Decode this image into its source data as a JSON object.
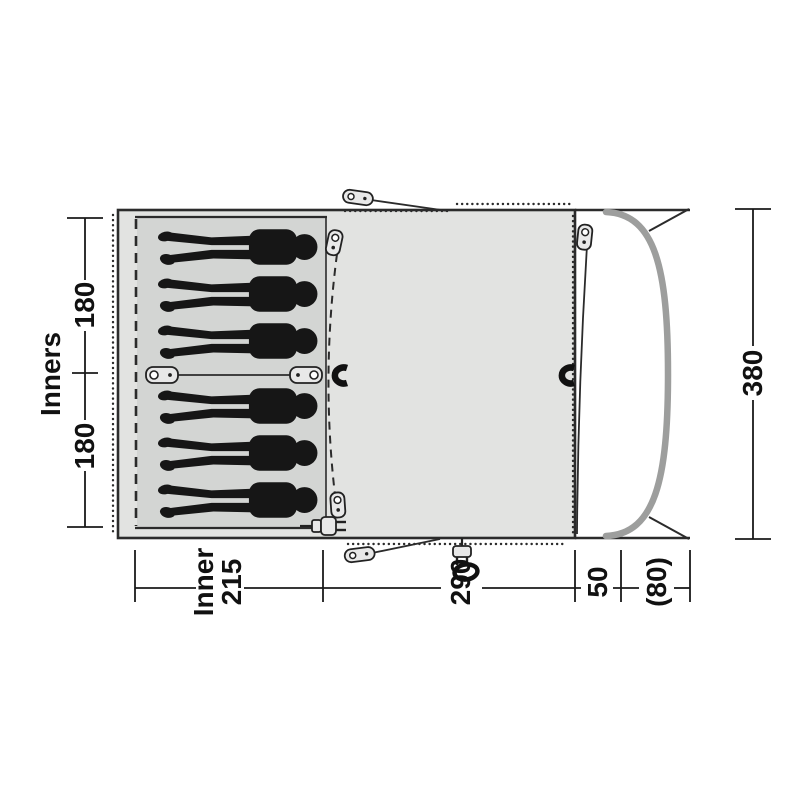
{
  "figure": {
    "kind": "tent floorplan top view",
    "sleeper_count": 6,
    "colors": {
      "background": "#ffffff",
      "body_fill": "#e2e3e1",
      "inner_fill": "#d3d5d3",
      "outline": "#2b2b2b",
      "silhouette": "#161616",
      "pole": "#9d9e9d",
      "dimension": "#111111"
    },
    "icons": [
      "tent-peg-icon",
      "zipper-pull-icon",
      "magnet-catch-icon",
      "divider-toggle-icon",
      "power-plug-icon",
      "cable-ring-icon"
    ]
  },
  "dims": {
    "inners_label": "Inners",
    "inner_half_top": "180",
    "inner_half_bottom": "180",
    "total_depth": "380",
    "inner_word": "Inner",
    "inner_depth": "215",
    "living_depth": "290",
    "front_strip": "50",
    "porch_depth": "(80)"
  }
}
